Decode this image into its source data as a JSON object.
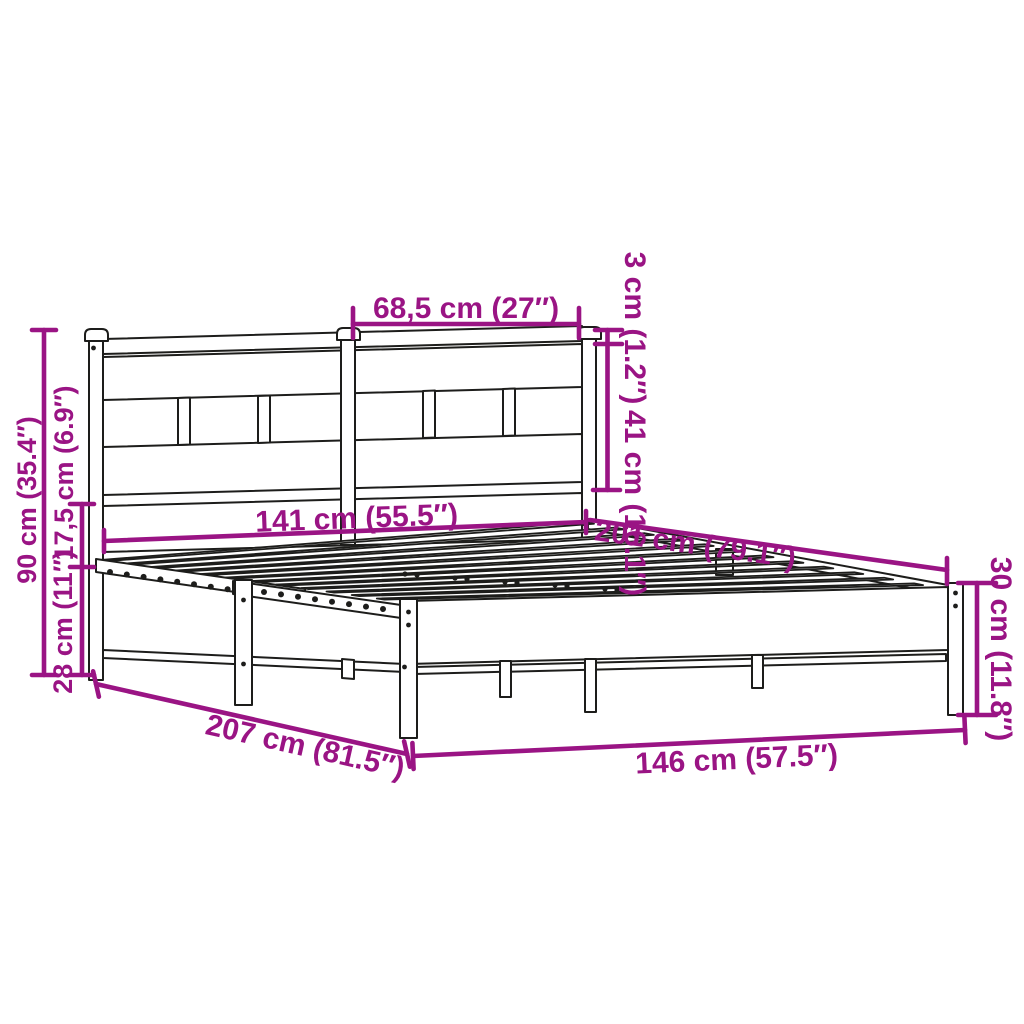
{
  "diagram": {
    "subject": "Metal bed frame with headboard - dimension drawing",
    "background_color": "#ffffff",
    "accent_color": "#9A1484",
    "outline_color": "#1d1d1b",
    "dimensions": {
      "headboard_top_width": "68,5 cm (27″)",
      "headboard_top_rail_thickness": "3 cm (1.2″)",
      "headboard_panel_height": "41 cm (16.1″)",
      "headboard_total_height": "90 cm (35.4″)",
      "headboard_panel_to_rail_gap": "17,5 cm (6.9″)",
      "under_bed_clearance": "28 cm (11″)",
      "frame_width_head": "141 cm (55.5″)",
      "frame_inner_length": "201 cm (79.1″)",
      "frame_total_length": "207 cm (81.5″)",
      "frame_width_foot": "146 cm (57.5″)",
      "side_rail_height": "30 cm (11.8″)"
    }
  }
}
